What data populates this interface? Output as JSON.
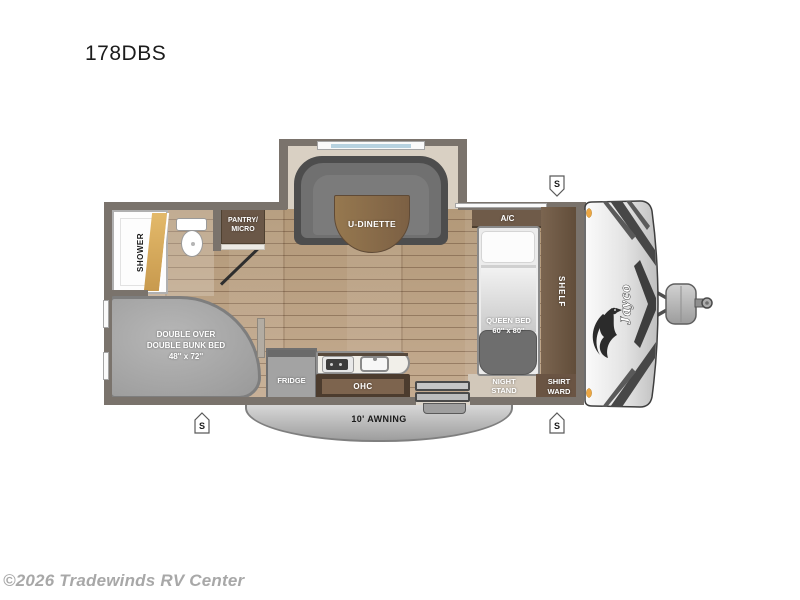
{
  "page": {
    "title": "178DBS",
    "watermark": "©2026 Tradewinds RV Center"
  },
  "brand": {
    "logo": "Jayco"
  },
  "labels": {
    "shower": "SHOWER",
    "pantry_line1": "PANTRY/",
    "pantry_line2": "MICRO",
    "u_dinette": "U-DINETTE",
    "ac": "A/C",
    "queen_line1": "QUEEN BED",
    "queen_line2": "60'' x 80''",
    "shelf": "SHELF",
    "night_line1": "NIGHT",
    "night_line2": "STAND",
    "shirt_line1": "SHIRT",
    "shirt_line2": "WARD",
    "bunk_line1": "DOUBLE OVER",
    "bunk_line2": "DOUBLE BUNK BED",
    "bunk_line3": "48'' x 72''",
    "fridge": "FRIDGE",
    "ohc": "OHC",
    "awning": "10' AWNING",
    "stabilizer": "S"
  },
  "colors": {
    "floor_wood": "#b89e84",
    "wall_gray": "#7a736c",
    "cabinet_brown": "#6a5747",
    "shelf_brown": "#5f4c3c",
    "couch_gray": "#6e6e6e",
    "table_brown": "#8a6c4e",
    "bed_foot_gray": "#6e6e6e",
    "awning_gray": "#b9b9b9",
    "shower_door_gold": "#d3a558",
    "marker_orange": "#eda743",
    "cap_silver": "#d9d9d9"
  }
}
